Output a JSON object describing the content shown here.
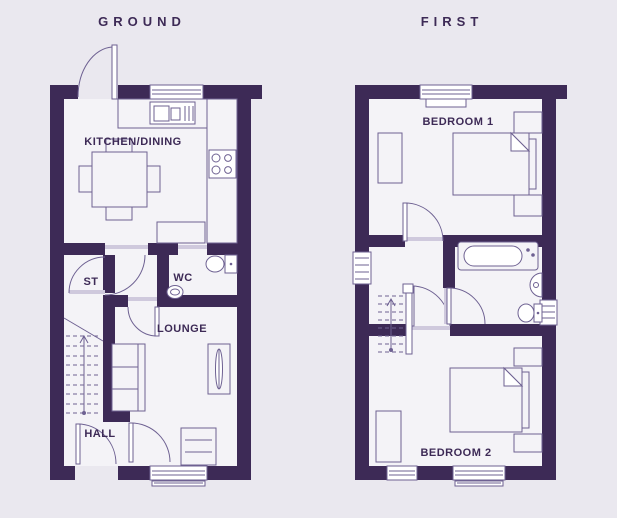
{
  "colors": {
    "background": "#eae8ef",
    "wall": "#3d2a56",
    "room": "#f4f3f7",
    "line": "#6e6192",
    "frame": "#cfc9dd",
    "label": "#3d2a56"
  },
  "floors": [
    {
      "title": "GROUND",
      "rooms": [
        {
          "name": "KITCHEN/DINING"
        },
        {
          "name": "ST"
        },
        {
          "name": "WC"
        },
        {
          "name": "LOUNGE"
        },
        {
          "name": "HALL"
        }
      ]
    },
    {
      "title": "FIRST",
      "rooms": [
        {
          "name": "BEDROOM 1"
        },
        {
          "name": "BEDROOM 2"
        }
      ]
    }
  ]
}
